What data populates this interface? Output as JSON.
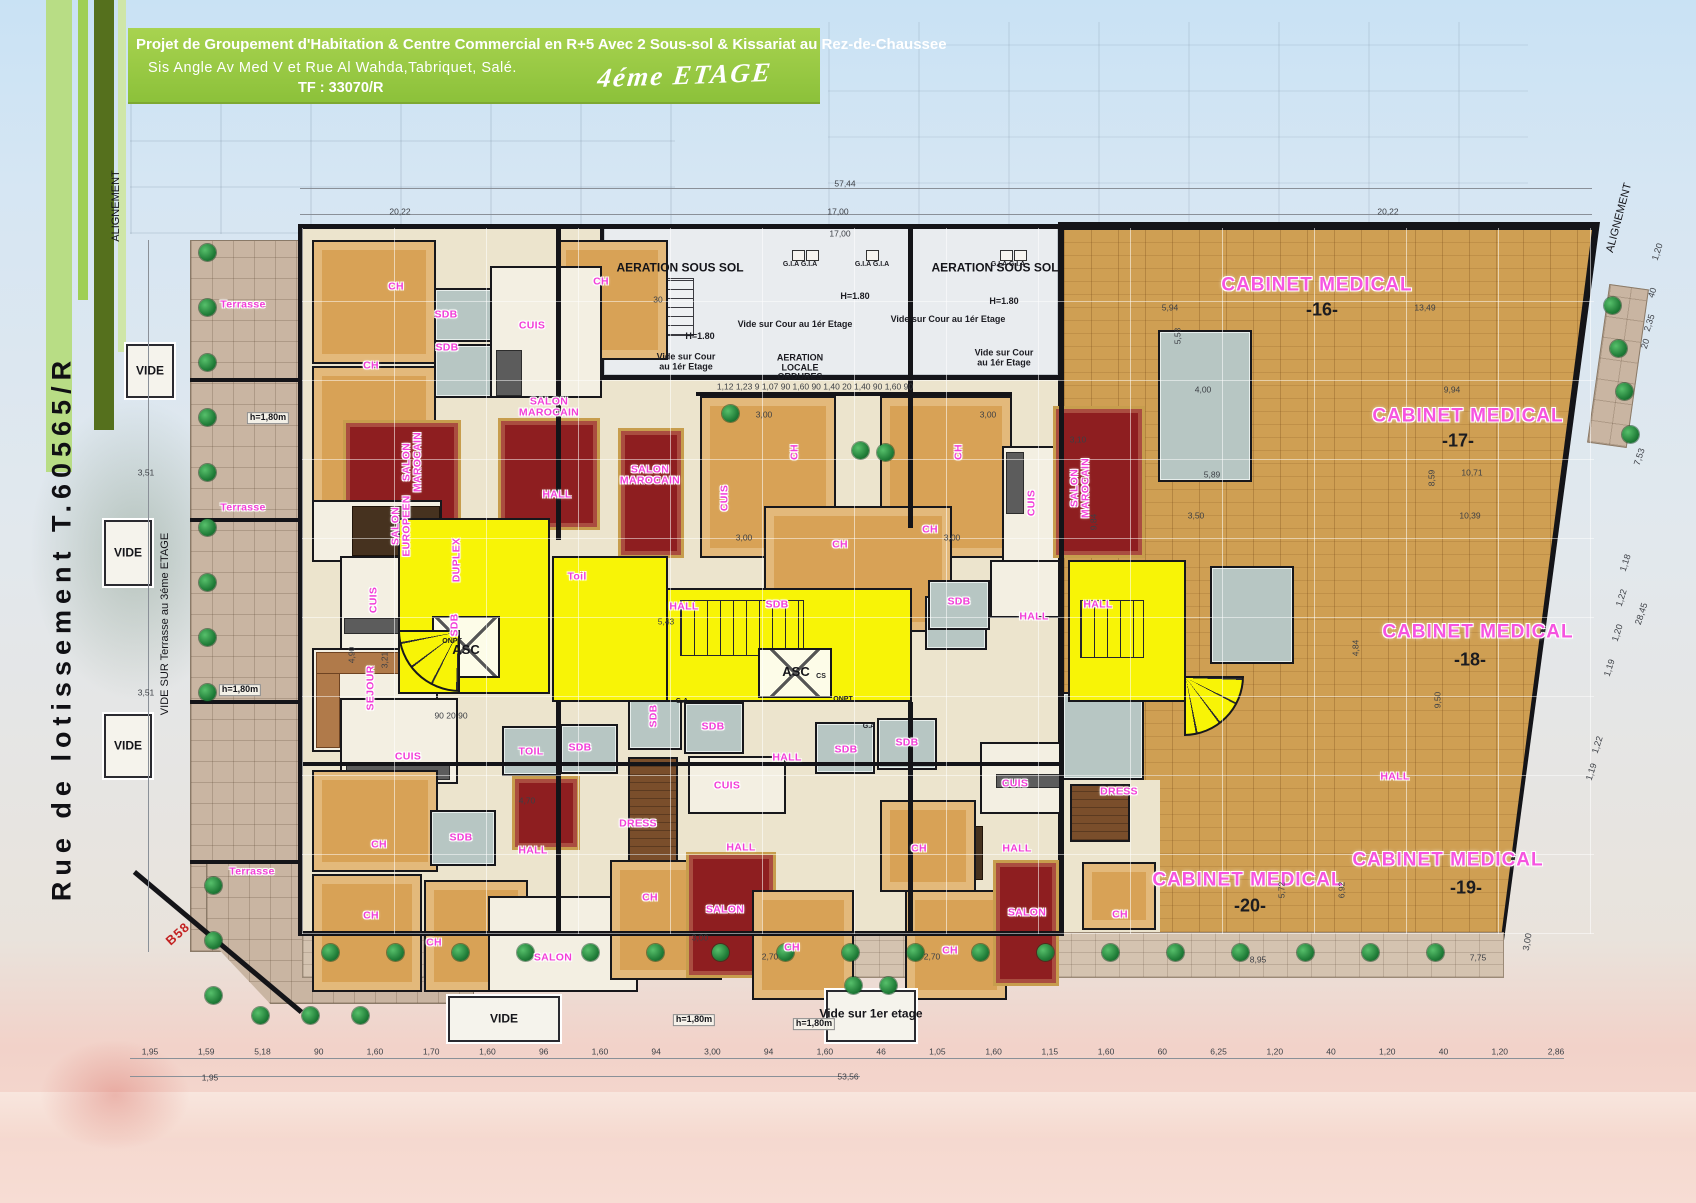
{
  "header": {
    "line1": "Projet de Groupement d'Habitation & Centre Commercial en R+5 Avec 2 Sous-sol & Kissariat au Rez-de-Chaussee",
    "line2": "Sis Angle Av Med V et Rue  Al Wahda,Tabriquet, Salé.",
    "line3": "TF : 33070/R",
    "floor": "4éme ETAGE"
  },
  "colors": {
    "header_green": "#8cc13a",
    "room_label_pink": "#f23fd8",
    "circulation_yellow": "#f8f406",
    "wood_floor": "#cf9f53",
    "carpet_red": "#8e1e20",
    "bath_gray": "#b7c6c3"
  },
  "dims": {
    "bottom_row": [
      "1,95",
      "1,59",
      "5,18",
      "90",
      "1,60",
      "1,70",
      "1,60",
      "96",
      "1,60",
      "94",
      "3,00",
      "94",
      "1,60",
      "46",
      "1,05",
      "1,60",
      "1,15",
      "1,60",
      "60",
      "6,25",
      "1,20",
      "40",
      "1,20",
      "40",
      "1,20",
      "2,86"
    ],
    "bottom_y": 1058,
    "bottom_x_start": 150,
    "bottom_x_end": 1556
  },
  "plan": {
    "labels": [
      {
        "t": "ALIGNEMENT",
        "x": 117,
        "y": 206,
        "s": "blkv",
        "r": -90
      },
      {
        "t": "ALIGNEMENT",
        "x": 1620,
        "y": 218,
        "s": "blkv",
        "r": -75
      },
      {
        "t": "57,44",
        "x": 845,
        "y": 184,
        "s": "dim"
      },
      {
        "t": "20,22",
        "x": 400,
        "y": 212,
        "s": "dim"
      },
      {
        "t": "17,00",
        "x": 838,
        "y": 212,
        "s": "dim"
      },
      {
        "t": "20,22",
        "x": 1388,
        "y": 212,
        "s": "dim"
      },
      {
        "t": "17,00",
        "x": 840,
        "y": 234,
        "s": "dim"
      },
      {
        "t": "30",
        "x": 658,
        "y": 300,
        "s": "dim"
      },
      {
        "t": "AERATION SOUS SOL",
        "x": 680,
        "y": 268,
        "s": "blk"
      },
      {
        "t": "AERATION SOUS SOL",
        "x": 995,
        "y": 268,
        "s": "blk"
      },
      {
        "t": "G.I.A  G.I.A",
        "x": 800,
        "y": 265,
        "s": "xs"
      },
      {
        "t": "G.I.A  G.I.A",
        "x": 872,
        "y": 265,
        "s": "xs"
      },
      {
        "t": "G.I.A  G.I.A",
        "x": 1008,
        "y": 265,
        "s": "xs"
      },
      {
        "t": "H=1.80",
        "x": 855,
        "y": 297,
        "s": "sm"
      },
      {
        "t": "H=1.80",
        "x": 1004,
        "y": 302,
        "s": "sm"
      },
      {
        "t": "H=1.80",
        "x": 700,
        "y": 337,
        "s": "sm"
      },
      {
        "t": "Vide sur Cour au 1ér Etage",
        "x": 795,
        "y": 325,
        "s": "sm"
      },
      {
        "t": "Vide sur Cour au 1ér Etage",
        "x": 948,
        "y": 320,
        "s": "sm"
      },
      {
        "t": "Vide sur Cour\nau 1ér Etage",
        "x": 686,
        "y": 362,
        "s": "sm"
      },
      {
        "t": "Vide sur Cour\nau 1ér Etage",
        "x": 1004,
        "y": 358,
        "s": "sm"
      },
      {
        "t": "AERATION\nLOCALE\nORDURES",
        "x": 800,
        "y": 368,
        "s": "sm"
      },
      {
        "t": "1,12   1,23   9   1,07   90   1,60   90   1,40  20  1,40   90   1,60   90",
        "x": 815,
        "y": 387,
        "s": "dim"
      },
      {
        "t": "CABINET MEDICAL",
        "x": 1317,
        "y": 286,
        "s": "pkb"
      },
      {
        "t": "-16-",
        "x": 1322,
        "y": 310,
        "s": "num"
      },
      {
        "t": "CABINET MEDICAL",
        "x": 1468,
        "y": 417,
        "s": "pkb"
      },
      {
        "t": "-17-",
        "x": 1458,
        "y": 441,
        "s": "num"
      },
      {
        "t": "CABINET MEDICAL",
        "x": 1478,
        "y": 633,
        "s": "pkb"
      },
      {
        "t": "-18-",
        "x": 1470,
        "y": 660,
        "s": "num"
      },
      {
        "t": "CABINET MEDICAL",
        "x": 1248,
        "y": 881,
        "s": "pkb"
      },
      {
        "t": "-20-",
        "x": 1250,
        "y": 906,
        "s": "num"
      },
      {
        "t": "CABINET MEDICAL",
        "x": 1448,
        "y": 861,
        "s": "pkb"
      },
      {
        "t": "-19-",
        "x": 1466,
        "y": 888,
        "s": "num"
      },
      {
        "t": "HALL",
        "x": 1395,
        "y": 777,
        "s": "pk"
      },
      {
        "t": "Terrasse",
        "x": 243,
        "y": 305,
        "s": "pk"
      },
      {
        "t": "Terrasse",
        "x": 243,
        "y": 508,
        "s": "pk"
      },
      {
        "t": "Terrasse",
        "x": 252,
        "y": 872,
        "s": "pk"
      },
      {
        "t": "VIDE",
        "x": 150,
        "y": 371,
        "s": "blk"
      },
      {
        "t": "VIDE",
        "x": 128,
        "y": 553,
        "s": "blk"
      },
      {
        "t": "VIDE",
        "x": 128,
        "y": 746,
        "s": "blk"
      },
      {
        "t": "VIDE",
        "x": 504,
        "y": 1019,
        "s": "blk"
      },
      {
        "t": "Vide sur 1er\netage",
        "x": 871,
        "y": 1014,
        "s": "blk"
      },
      {
        "t": "h=1,80m",
        "x": 268,
        "y": 418,
        "s": "smb"
      },
      {
        "t": "h=1,80m",
        "x": 240,
        "y": 690,
        "s": "smb"
      },
      {
        "t": "h=1,80m",
        "x": 694,
        "y": 1020,
        "s": "smb"
      },
      {
        "t": "h=1,80m",
        "x": 814,
        "y": 1024,
        "s": "smb"
      },
      {
        "t": "B58",
        "x": 178,
        "y": 934,
        "s": "red-lb",
        "r": -42
      },
      {
        "t": "VIDE SUR Terrasse au 3éme ETAGE",
        "x": 166,
        "y": 624,
        "s": "blkv",
        "r": -90
      },
      {
        "t": "Rue de lotissement T.60565/R",
        "x": 62,
        "y": 628,
        "s": "street",
        "r": -90
      },
      {
        "t": "CH",
        "x": 396,
        "y": 287,
        "s": "pk"
      },
      {
        "t": "SDB",
        "x": 446,
        "y": 315,
        "s": "pk"
      },
      {
        "t": "SDB",
        "x": 447,
        "y": 348,
        "s": "pk"
      },
      {
        "t": "CH",
        "x": 371,
        "y": 366,
        "s": "pk"
      },
      {
        "t": "CUIS",
        "x": 532,
        "y": 326,
        "s": "pk"
      },
      {
        "t": "CH",
        "x": 601,
        "y": 282,
        "s": "pk"
      },
      {
        "t": "SALON\nMAROCAIN",
        "x": 413,
        "y": 462,
        "s": "pkv",
        "r": -90
      },
      {
        "t": "SALON\nMAROCAIN",
        "x": 549,
        "y": 408,
        "s": "pk"
      },
      {
        "t": "SALON\nEUROPEEN",
        "x": 402,
        "y": 526,
        "s": "pkv",
        "r": -90
      },
      {
        "t": "HALL",
        "x": 557,
        "y": 495,
        "s": "pk"
      },
      {
        "t": "DUPLEX",
        "x": 457,
        "y": 560,
        "s": "pkv",
        "r": -90
      },
      {
        "t": "CUIS",
        "x": 374,
        "y": 600,
        "s": "pkv",
        "r": -90
      },
      {
        "t": "SDB",
        "x": 455,
        "y": 625,
        "s": "pkv",
        "r": -90
      },
      {
        "t": "SEJOUR",
        "x": 371,
        "y": 688,
        "s": "pkv",
        "r": -90
      },
      {
        "t": "Toil",
        "x": 577,
        "y": 577,
        "s": "pk"
      },
      {
        "t": "TOIL",
        "x": 531,
        "y": 752,
        "s": "pk"
      },
      {
        "t": "SDB",
        "x": 580,
        "y": 748,
        "s": "pk"
      },
      {
        "t": "CUIS",
        "x": 408,
        "y": 757,
        "s": "pk"
      },
      {
        "t": "ASC",
        "x": 466,
        "y": 650,
        "s": "blk2"
      },
      {
        "t": "90  20  90",
        "x": 451,
        "y": 716,
        "s": "dim"
      },
      {
        "t": "3,21",
        "x": 385,
        "y": 660,
        "s": "dim",
        "r": -90
      },
      {
        "t": "SALON\nMAROCAIN",
        "x": 650,
        "y": 476,
        "s": "pk"
      },
      {
        "t": "CUIS",
        "x": 725,
        "y": 498,
        "s": "pkv",
        "r": -90
      },
      {
        "t": "CH",
        "x": 795,
        "y": 452,
        "s": "pkv",
        "r": -90
      },
      {
        "t": "CH",
        "x": 959,
        "y": 452,
        "s": "pkv",
        "r": -90
      },
      {
        "t": "CH",
        "x": 840,
        "y": 545,
        "s": "pk"
      },
      {
        "t": "CH",
        "x": 930,
        "y": 530,
        "s": "pk"
      },
      {
        "t": "HALL",
        "x": 684,
        "y": 607,
        "s": "pk"
      },
      {
        "t": "5,43",
        "x": 666,
        "y": 622,
        "s": "dim"
      },
      {
        "t": "SDB",
        "x": 777,
        "y": 605,
        "s": "pk"
      },
      {
        "t": "SDB",
        "x": 959,
        "y": 602,
        "s": "pk"
      },
      {
        "t": "ASC",
        "x": 796,
        "y": 672,
        "s": "blk2"
      },
      {
        "t": "CS",
        "x": 821,
        "y": 677,
        "s": "xs"
      },
      {
        "t": "ONPT",
        "x": 843,
        "y": 700,
        "s": "xs"
      },
      {
        "t": "ONPT",
        "x": 452,
        "y": 642,
        "s": "xs"
      },
      {
        "t": "CUIS",
        "x": 1032,
        "y": 503,
        "s": "pkv",
        "r": -90
      },
      {
        "t": "SALON\nMAROCAIN",
        "x": 1081,
        "y": 488,
        "s": "pkv",
        "r": -90
      },
      {
        "t": "3,10",
        "x": 1078,
        "y": 440,
        "s": "dim"
      },
      {
        "t": "9,84",
        "x": 1094,
        "y": 522,
        "s": "dim",
        "r": -90
      },
      {
        "t": "HALL",
        "x": 1034,
        "y": 617,
        "s": "pk"
      },
      {
        "t": "HALL",
        "x": 1098,
        "y": 605,
        "s": "pk"
      },
      {
        "t": "G.A",
        "x": 682,
        "y": 702,
        "s": "xs"
      },
      {
        "t": "G.A",
        "x": 869,
        "y": 727,
        "s": "xs"
      },
      {
        "t": "SDB",
        "x": 654,
        "y": 716,
        "s": "pkv",
        "r": -90
      },
      {
        "t": "SDB",
        "x": 713,
        "y": 727,
        "s": "pk"
      },
      {
        "t": "SDB",
        "x": 846,
        "y": 750,
        "s": "pk"
      },
      {
        "t": "SDB",
        "x": 907,
        "y": 743,
        "s": "pk"
      },
      {
        "t": "HALL",
        "x": 787,
        "y": 758,
        "s": "pk"
      },
      {
        "t": "CUIS",
        "x": 727,
        "y": 786,
        "s": "pk"
      },
      {
        "t": "DRESS",
        "x": 638,
        "y": 824,
        "s": "pk"
      },
      {
        "t": "HALL",
        "x": 741,
        "y": 848,
        "s": "pk"
      },
      {
        "t": "4,70",
        "x": 527,
        "y": 801,
        "s": "dim"
      },
      {
        "t": "CH",
        "x": 650,
        "y": 898,
        "s": "pk"
      },
      {
        "t": "SALON",
        "x": 725,
        "y": 910,
        "s": "pk"
      },
      {
        "t": "CH",
        "x": 792,
        "y": 948,
        "s": "pk"
      },
      {
        "t": "CH",
        "x": 950,
        "y": 951,
        "s": "pk"
      },
      {
        "t": "CH",
        "x": 379,
        "y": 845,
        "s": "pk"
      },
      {
        "t": "SDB",
        "x": 461,
        "y": 838,
        "s": "pk"
      },
      {
        "t": "CH",
        "x": 371,
        "y": 916,
        "s": "pk"
      },
      {
        "t": "CH",
        "x": 434,
        "y": 943,
        "s": "pk"
      },
      {
        "t": "HALL",
        "x": 533,
        "y": 851,
        "s": "pk"
      },
      {
        "t": "SALON",
        "x": 553,
        "y": 958,
        "s": "pk"
      },
      {
        "t": "CUIS",
        "x": 1015,
        "y": 784,
        "s": "pk"
      },
      {
        "t": "HALL",
        "x": 1017,
        "y": 849,
        "s": "pk"
      },
      {
        "t": "SALON",
        "x": 1027,
        "y": 913,
        "s": "pk"
      },
      {
        "t": "CH",
        "x": 919,
        "y": 849,
        "s": "pk"
      },
      {
        "t": "DRESS",
        "x": 1119,
        "y": 792,
        "s": "pk"
      },
      {
        "t": "CH",
        "x": 1120,
        "y": 915,
        "s": "pk"
      },
      {
        "t": "5,94",
        "x": 1170,
        "y": 308,
        "s": "dim"
      },
      {
        "t": "13,49",
        "x": 1425,
        "y": 308,
        "s": "dim"
      },
      {
        "t": "5,58",
        "x": 1178,
        "y": 336,
        "s": "dim",
        "r": -90
      },
      {
        "t": "4,00",
        "x": 1203,
        "y": 390,
        "s": "dim"
      },
      {
        "t": "5,89",
        "x": 1212,
        "y": 475,
        "s": "dim"
      },
      {
        "t": "3,50",
        "x": 1196,
        "y": 516,
        "s": "dim"
      },
      {
        "t": "9,94",
        "x": 1452,
        "y": 390,
        "s": "dim"
      },
      {
        "t": "10,71",
        "x": 1472,
        "y": 473,
        "s": "dim"
      },
      {
        "t": "10,39",
        "x": 1470,
        "y": 516,
        "s": "dim"
      },
      {
        "t": "8,59",
        "x": 1432,
        "y": 478,
        "s": "dim",
        "r": -90
      },
      {
        "t": "4,84",
        "x": 1356,
        "y": 648,
        "s": "dim",
        "r": -90
      },
      {
        "t": "9,50",
        "x": 1438,
        "y": 700,
        "s": "dim",
        "r": -90
      },
      {
        "t": "8,95",
        "x": 1258,
        "y": 960,
        "s": "dim"
      },
      {
        "t": "7,75",
        "x": 1478,
        "y": 958,
        "s": "dim"
      },
      {
        "t": "5,72",
        "x": 1282,
        "y": 890,
        "s": "dim",
        "r": -90
      },
      {
        "t": "6,92",
        "x": 1342,
        "y": 890,
        "s": "dim",
        "r": -90
      },
      {
        "t": "3,51",
        "x": 146,
        "y": 473,
        "s": "dim"
      },
      {
        "t": "3,51",
        "x": 146,
        "y": 693,
        "s": "dim"
      },
      {
        "t": "4,90",
        "x": 352,
        "y": 655,
        "s": "dim",
        "r": -90
      },
      {
        "t": "3,00",
        "x": 764,
        "y": 415,
        "s": "dim"
      },
      {
        "t": "3,00",
        "x": 988,
        "y": 415,
        "s": "dim"
      },
      {
        "t": "3,00",
        "x": 744,
        "y": 538,
        "s": "dim"
      },
      {
        "t": "3,00",
        "x": 952,
        "y": 538,
        "s": "dim"
      },
      {
        "t": "2,70",
        "x": 770,
        "y": 957,
        "s": "dim"
      },
      {
        "t": "2,70",
        "x": 932,
        "y": 957,
        "s": "dim"
      },
      {
        "t": "3,00",
        "x": 700,
        "y": 938,
        "s": "dim"
      },
      {
        "t": "53,56",
        "x": 848,
        "y": 1077,
        "s": "dim"
      },
      {
        "t": "1,95",
        "x": 210,
        "y": 1078,
        "s": "dim"
      },
      {
        "t": "1,20",
        "x": 1658,
        "y": 252,
        "s": "dimr",
        "r": -72
      },
      {
        "t": "40",
        "x": 1653,
        "y": 293,
        "s": "dimr",
        "r": -72
      },
      {
        "t": "2,35",
        "x": 1650,
        "y": 323,
        "s": "dimr",
        "r": -72
      },
      {
        "t": "20",
        "x": 1646,
        "y": 344,
        "s": "dimr",
        "r": -72
      },
      {
        "t": "7,53",
        "x": 1640,
        "y": 457,
        "s": "dimr",
        "r": -72
      },
      {
        "t": "1,18",
        "x": 1626,
        "y": 563,
        "s": "dimr",
        "r": -72
      },
      {
        "t": "1,22",
        "x": 1622,
        "y": 598,
        "s": "dimr",
        "r": -72
      },
      {
        "t": "28,45",
        "x": 1642,
        "y": 614,
        "s": "dimr",
        "r": -72
      },
      {
        "t": "1,20",
        "x": 1618,
        "y": 633,
        "s": "dimr",
        "r": -72
      },
      {
        "t": "1,19",
        "x": 1610,
        "y": 668,
        "s": "dimr",
        "r": -72
      },
      {
        "t": "1,22",
        "x": 1598,
        "y": 745,
        "s": "dimr",
        "r": -72
      },
      {
        "t": "1,19",
        "x": 1592,
        "y": 772,
        "s": "dimr",
        "r": -72
      },
      {
        "t": "3,00",
        "x": 1528,
        "y": 942,
        "s": "dimr",
        "r": -80
      }
    ]
  }
}
